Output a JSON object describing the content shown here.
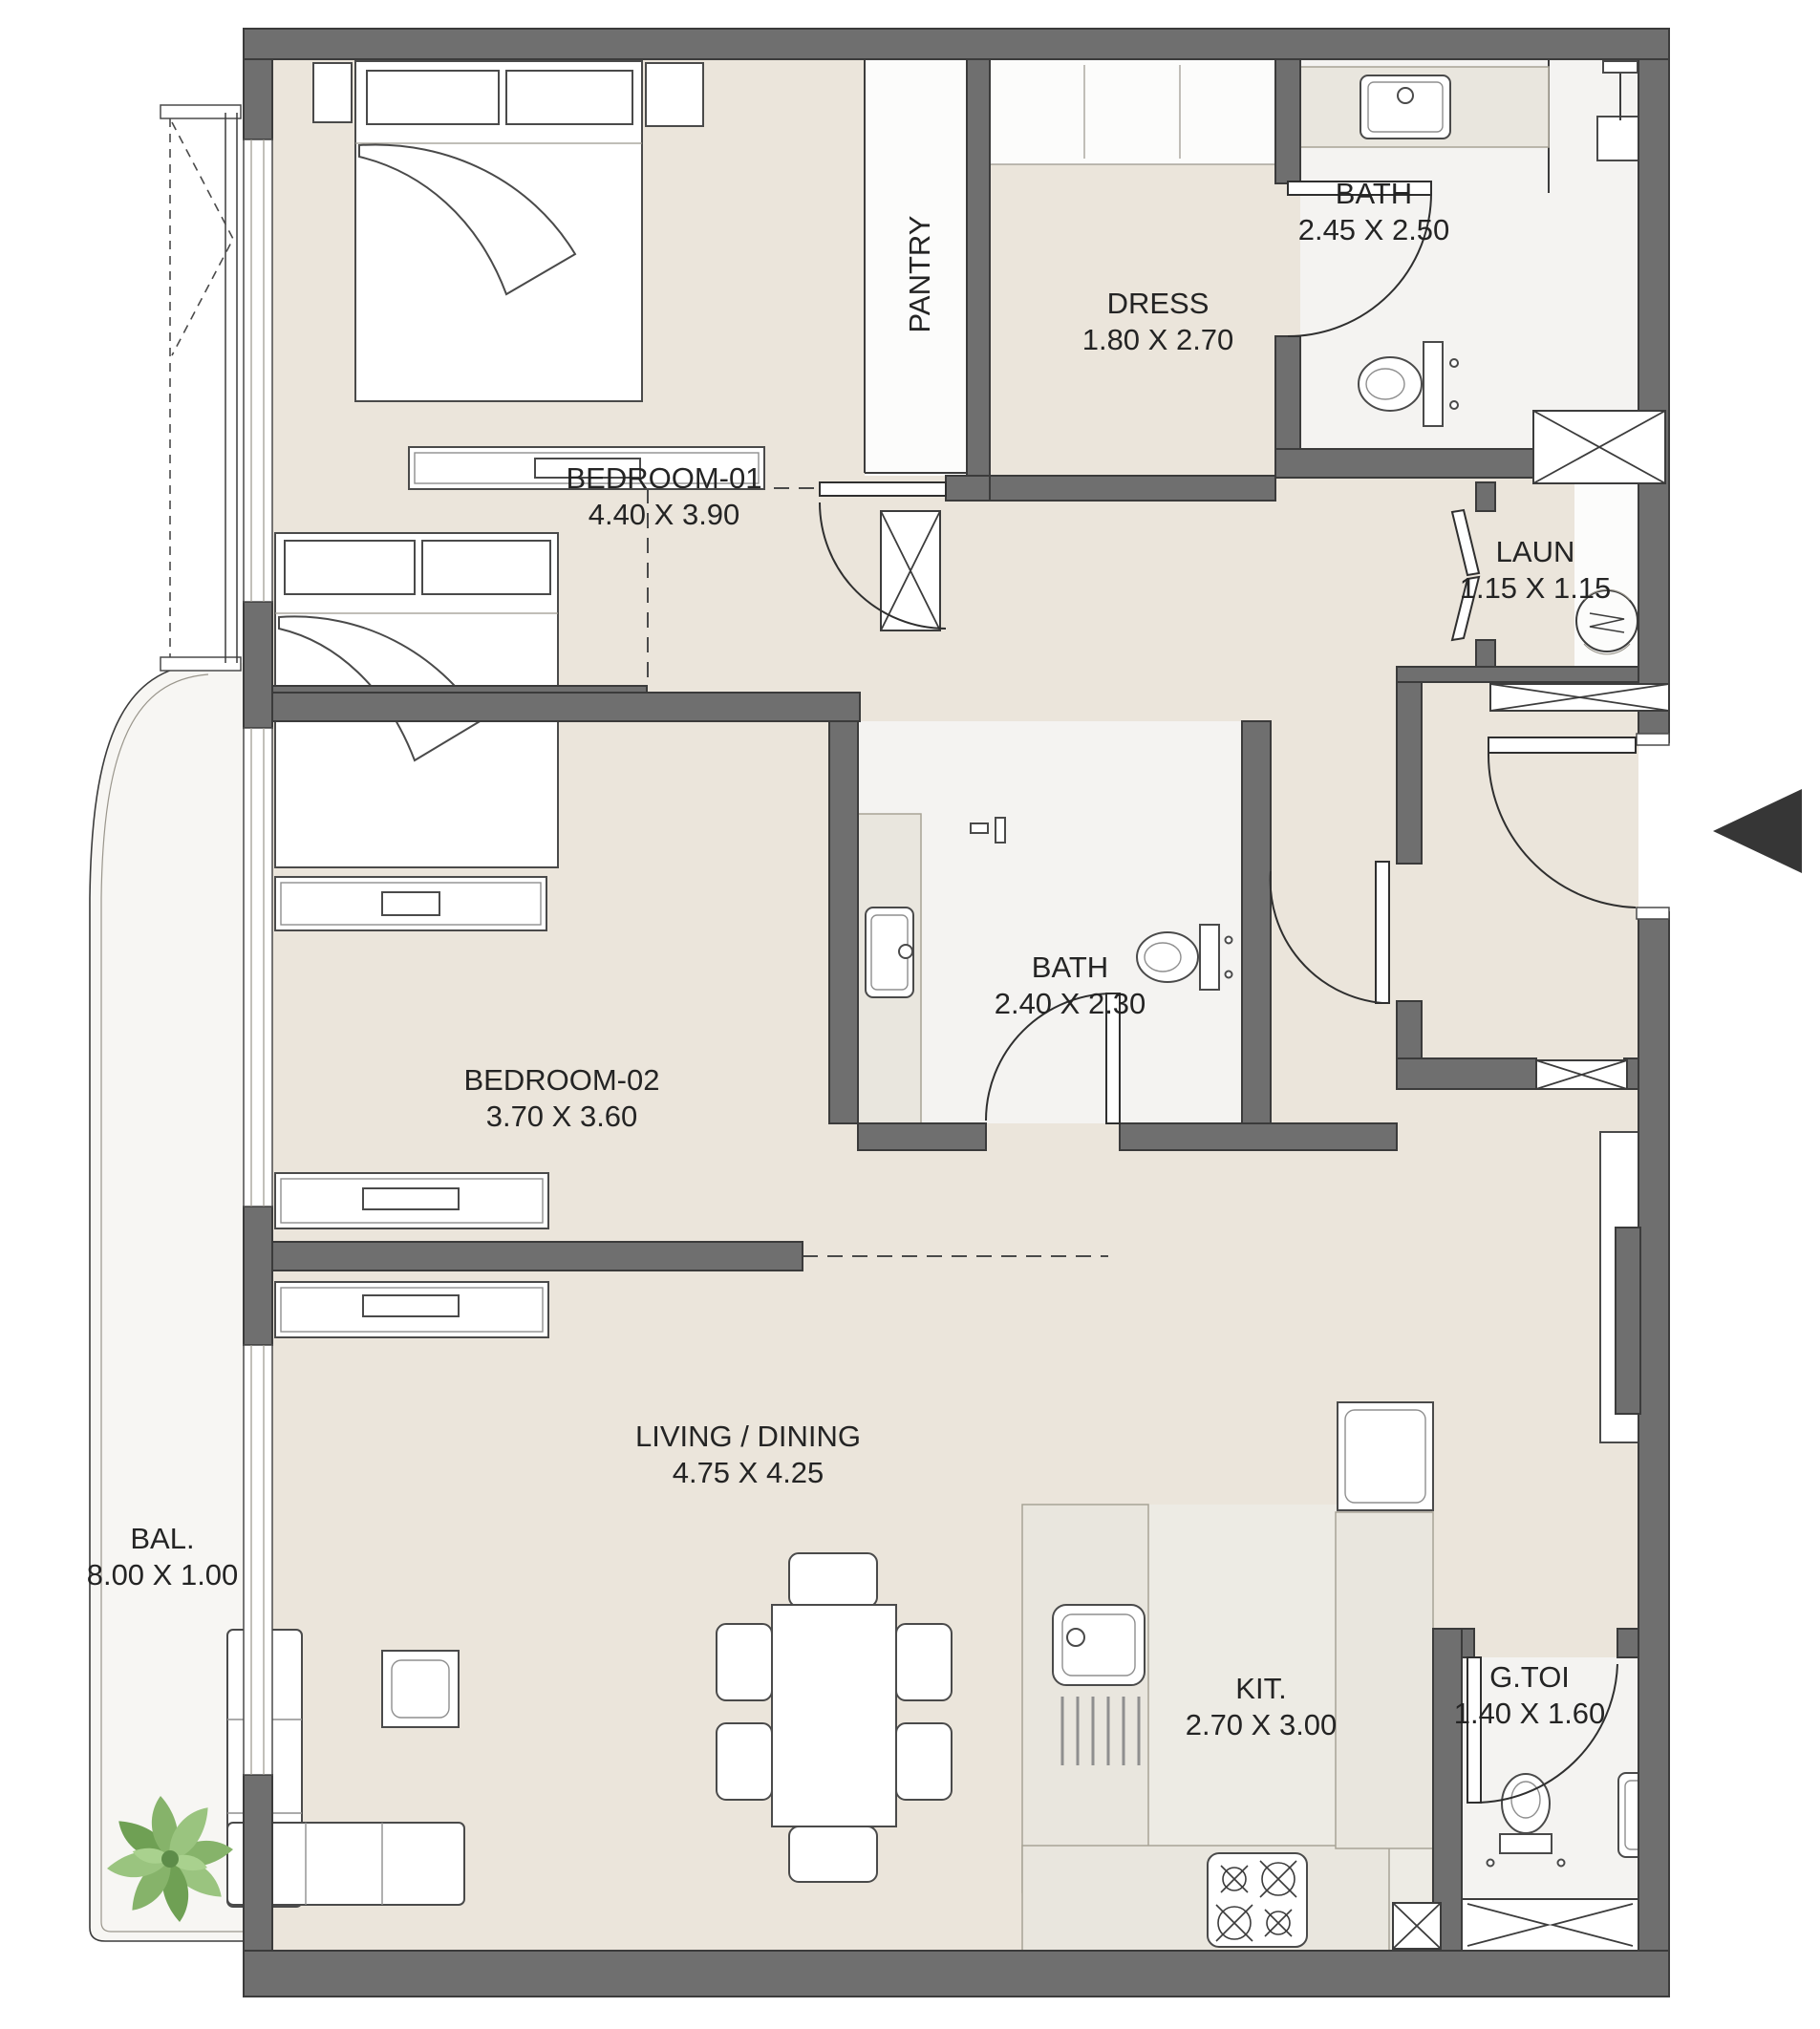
{
  "rooms": {
    "bedroom1": {
      "name": "BEDROOM-01",
      "dims": "4.40 X 3.90"
    },
    "pantry": {
      "name": "PANTRY"
    },
    "dress": {
      "name": "DRESS",
      "dims": "1.80 X 2.70"
    },
    "bath1": {
      "name": "BATH",
      "dims": "2.45 X 2.50"
    },
    "laun": {
      "name": "LAUN",
      "dims": "1.15 X 1.15"
    },
    "bedroom2": {
      "name": "BEDROOM-02",
      "dims": "3.70 X 3.60"
    },
    "bath2": {
      "name": "BATH",
      "dims": "2.40 X 2.30"
    },
    "living": {
      "name": "LIVING / DINING",
      "dims": "4.75 X 4.25"
    },
    "balcony": {
      "name": "BAL.",
      "dims": "8.00 X 1.00"
    },
    "kitchen": {
      "name": "KIT.",
      "dims": "2.70 X 3.00"
    },
    "gtoi": {
      "name": "G.TOI",
      "dims": "1.40 X 1.60"
    }
  },
  "colors": {
    "wall": "#6f6f6f",
    "wall_stroke": "#3b3b3b",
    "floor": "#ebe5db",
    "bath_floor": "#f4f3f1",
    "marble": "#e9e6de",
    "plant_green": "#86b36a",
    "arrow": "#363636",
    "label_text": "#242424"
  },
  "icons": {
    "entry_arrow": "left-pointing-triangle",
    "washing_machine": "drum-circle",
    "plant": "monstera-top-view",
    "stove": "four-burner-hob",
    "closet_marks": "x-cross"
  }
}
